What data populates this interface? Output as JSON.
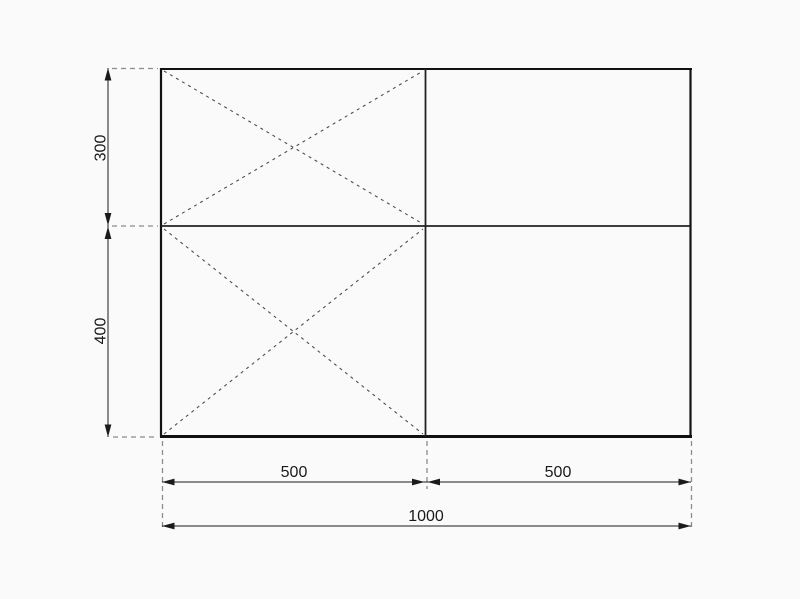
{
  "diagram": {
    "labels": {
      "top_height": "300",
      "bottom_height": "400",
      "left_width": "500",
      "right_width": "500",
      "total_width": "1000"
    },
    "colors": {
      "background": "#fafafa",
      "outline": "#111111",
      "interior_wall": "#222222",
      "dimension_line": "#1a1a1a",
      "diagonal_dash": "#4d4d4d",
      "extension_dash": "#8c8c8c",
      "text": "#1a1a1a"
    }
  }
}
